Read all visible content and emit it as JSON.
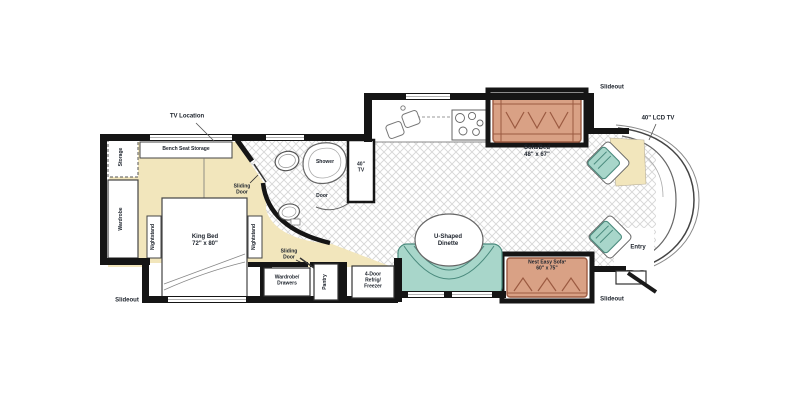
{
  "meta": {
    "type": "Motorhome floor plan diagram"
  },
  "colors": {
    "floor_cream": "#F2E6BC",
    "sofa_fill": "#D9A185",
    "sofa_stroke": "#9B5A41",
    "teal_fill": "#A8D6CA",
    "teal_stroke": "#4A8A7D",
    "wall": "#151515",
    "hatch_line": "#D6D6D6",
    "label_text": "#20262F"
  },
  "labels": {
    "tv_location": "TV Location",
    "bench_seat_storage": "Bench Seat Storage",
    "storage": "Storage",
    "wardrobe": "Wardrobe",
    "nightstand": "Nightstand",
    "king_bed": "King Bed\n72\" x 80\"",
    "sliding_door": "Sliding\nDoor",
    "slideout": "Slideout",
    "shower": "Shower",
    "door": "Door",
    "tv_40": "40\"\nTV",
    "wardrobe_drawers": "Wardrobe/\nDrawers",
    "pantry": "Pantry",
    "refrigerator": "4-Door\nRefrig/\nFreezer",
    "dinette": "U-Shaped\nDinette",
    "sofa_bed": "Sofa/Bed\n48\" x 67\"",
    "nest_easy_sofa": "Nest Easy Sofa³\n60\" x 75\"",
    "lcd_tv": "40\" LCD TV",
    "entry": "Entry"
  }
}
